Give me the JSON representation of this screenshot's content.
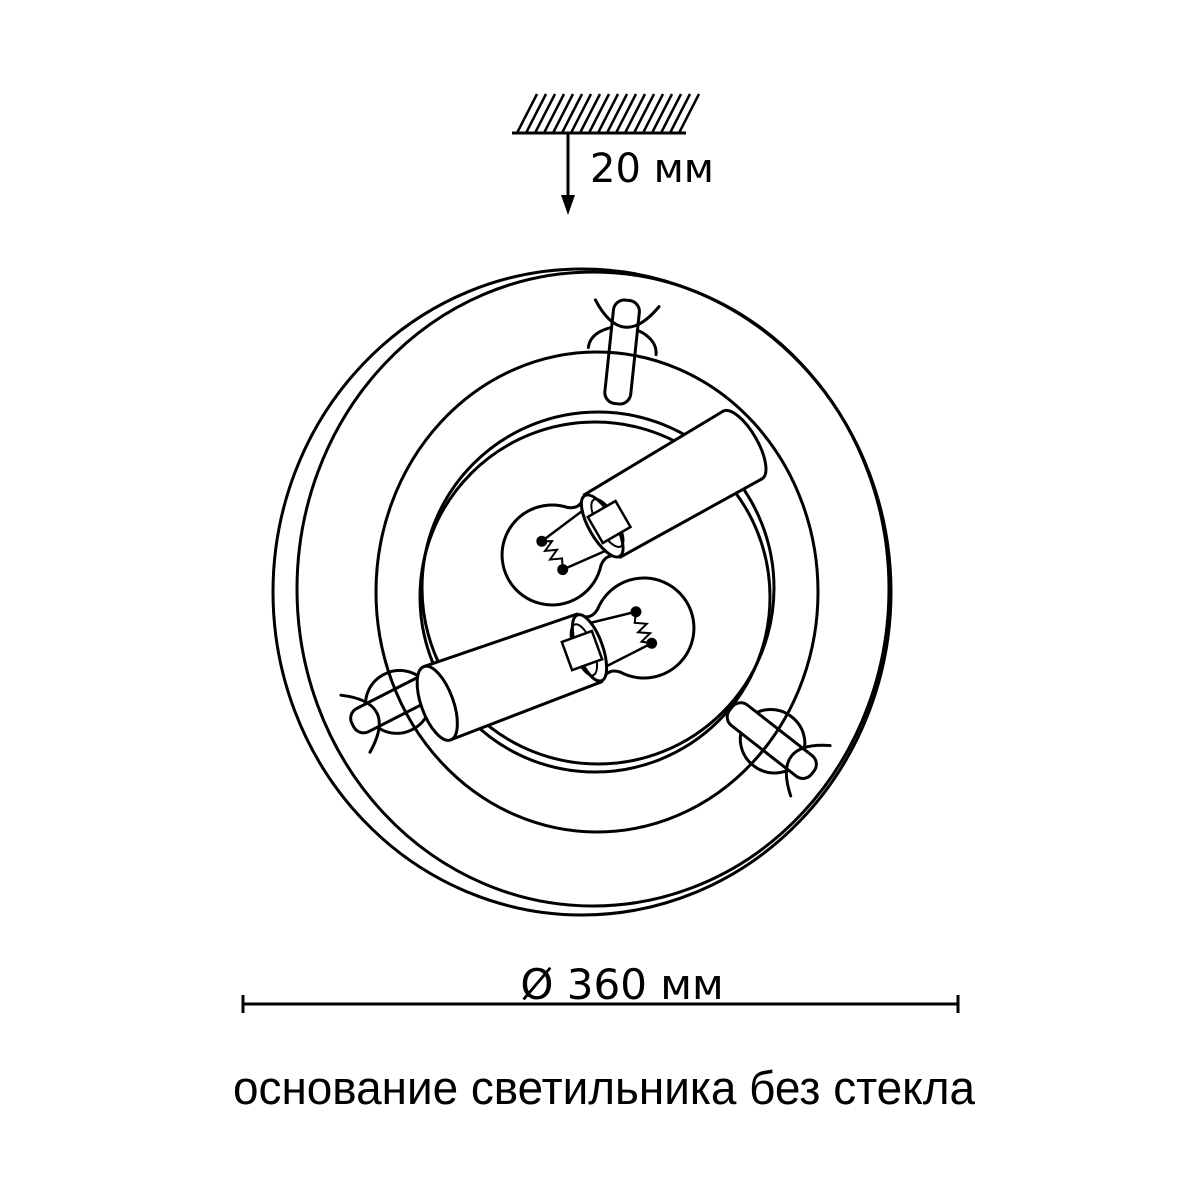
{
  "page": {
    "background_color": "#ffffff",
    "line_color": "#000000"
  },
  "diagram": {
    "kind": "ceiling-lamp-base-technical-drawing",
    "bulb_count": 2,
    "clip_count": 3,
    "labels": {
      "ceiling_offset": "20 мм",
      "diameter": "Ø 360 мм",
      "caption": "основание светильника без стекла"
    }
  }
}
